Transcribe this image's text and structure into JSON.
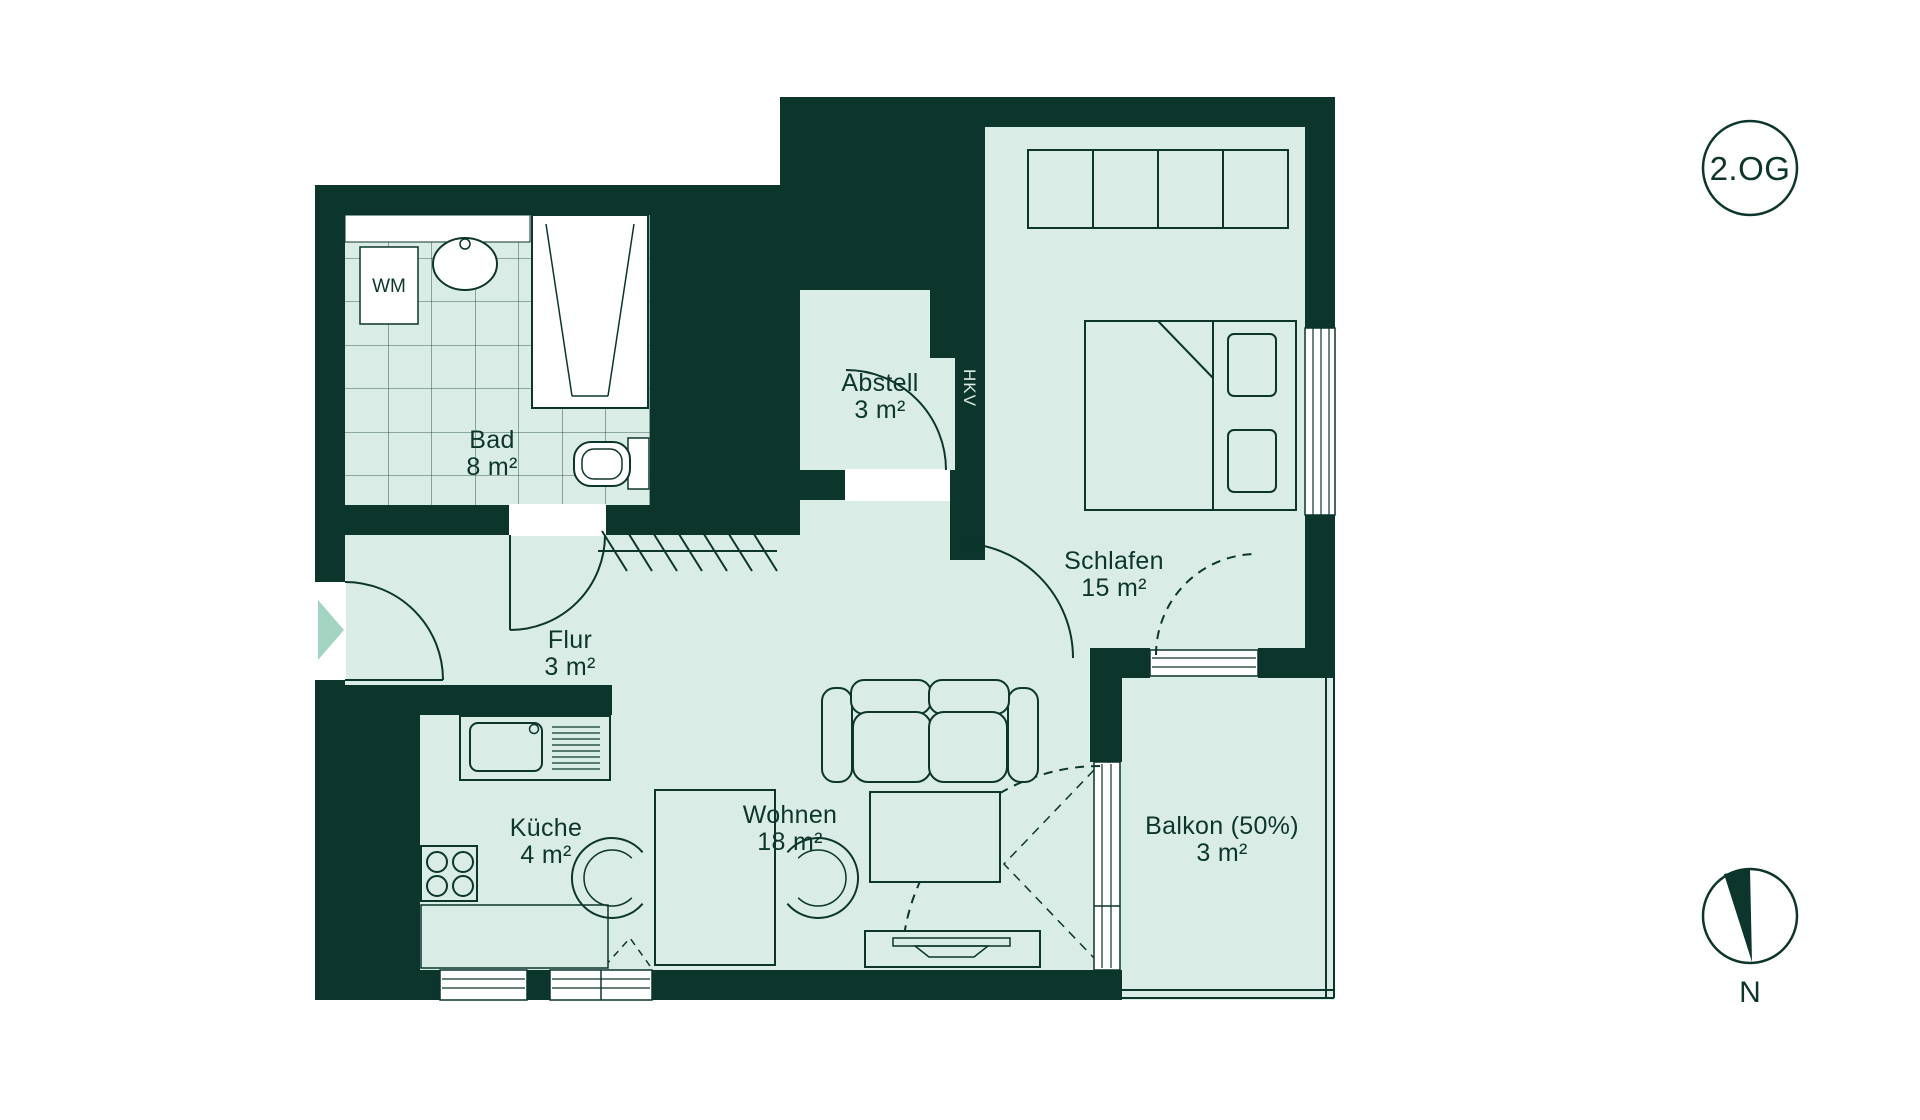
{
  "floor_badge": {
    "label": "2.OG"
  },
  "compass": {
    "north_label": "N"
  },
  "rooms": [
    {
      "id": "bad",
      "name": "Bad",
      "area": "8 m²"
    },
    {
      "id": "abstell",
      "name": "Abstell",
      "area": "3 m²"
    },
    {
      "id": "schlafen",
      "name": "Schlafen",
      "area": "15 m²"
    },
    {
      "id": "flur",
      "name": "Flur",
      "area": "3 m²"
    },
    {
      "id": "kueche",
      "name": "Küche",
      "area": "4 m²"
    },
    {
      "id": "wohnen",
      "name": "Wohnen",
      "area": "18 m²"
    },
    {
      "id": "balkon",
      "name": "Balkon (50%)",
      "area": "3 m²"
    }
  ],
  "fixtures": {
    "washing_machine": "WM",
    "heating_circuit_valve": "HKV"
  },
  "colors": {
    "wall": "#0c352b",
    "floor_fill": "#d9ece6",
    "entry_arrow": "#a3d4c2",
    "background": "#ffffff"
  }
}
